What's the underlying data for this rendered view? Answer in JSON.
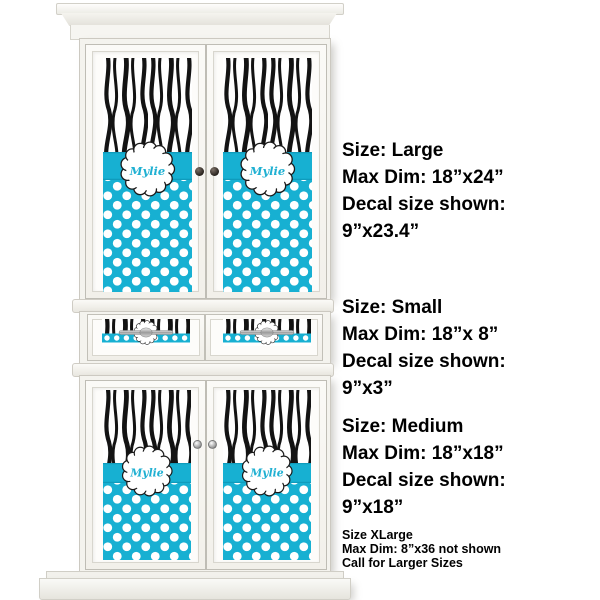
{
  "canvas": {
    "width": 600,
    "height": 600,
    "background": "#ffffff"
  },
  "colors": {
    "teal": "#17b0d2",
    "teal_edge": "#0d93b2",
    "zebra_black": "#131313",
    "script_teal": "#1fb0d2",
    "text_black": "#000000"
  },
  "decal": {
    "name": "Mylie",
    "pattern_top": "zebra",
    "pattern_bottom": "polka-dots"
  },
  "size_info": [
    {
      "size": "Size: Large",
      "max_dim": "Max Dim: 18”x24”",
      "decal_label": "Decal size shown:",
      "decal_size": "9”x23.4”"
    },
    {
      "size": "Size: Small",
      "max_dim": "Max Dim: 18”x 8”",
      "decal_label": "Decal size shown:",
      "decal_size": "9”x3”"
    },
    {
      "size": "Size: Medium",
      "max_dim": "Max Dim: 18”x18”",
      "decal_label": "Decal size shown:",
      "decal_size": "9”x18”"
    }
  ],
  "xlarge_note": {
    "size": "Size XLarge",
    "max_dim": "Max Dim: 8”x36 not shown",
    "call": "Call for Larger Sizes"
  }
}
